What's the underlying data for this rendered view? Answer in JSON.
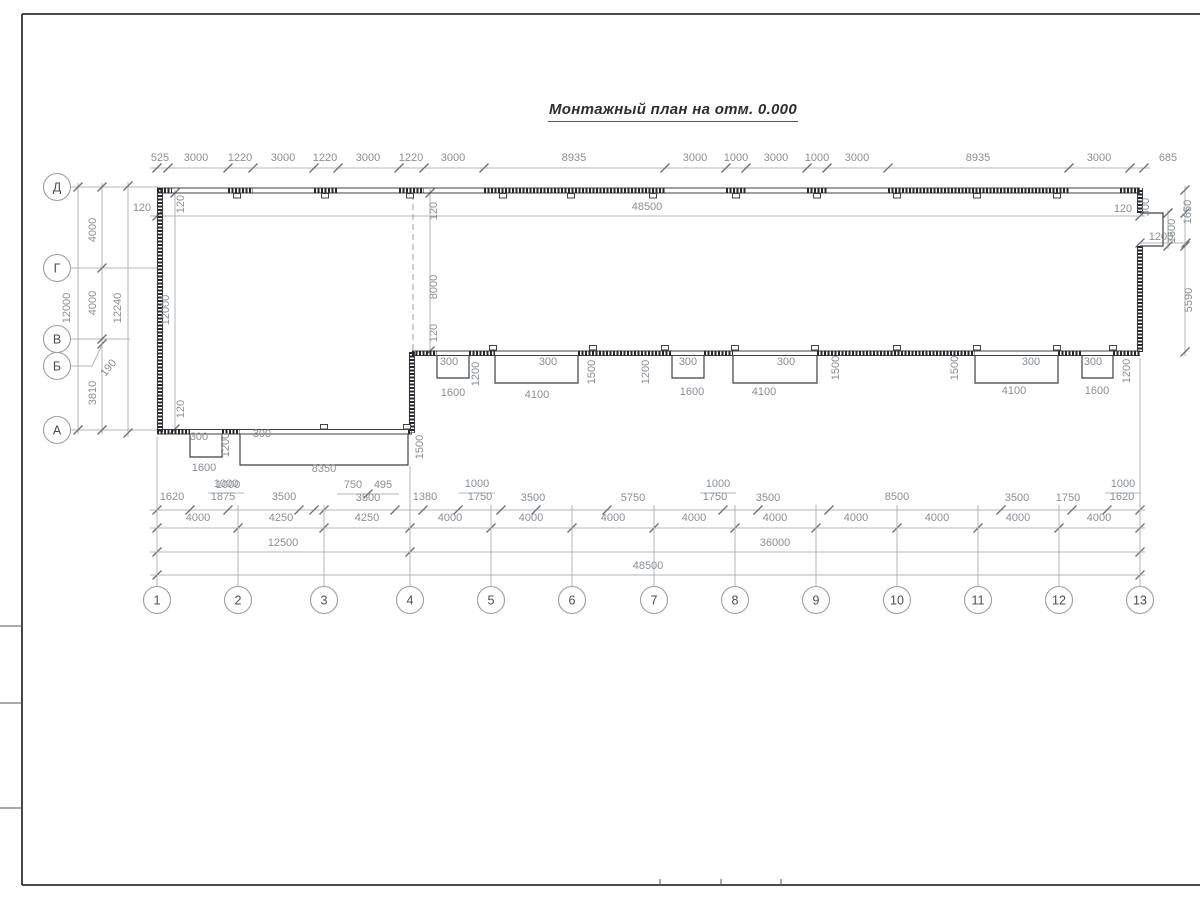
{
  "title": "Монтажный план на отм. 0.000",
  "colors": {
    "wall": "#3c4043",
    "wall_panel": "#26282b",
    "dim_line": "#b2b6ba",
    "dim_tick": "#6b6f73",
    "dim_text": "#8a8f94",
    "frame": "#333333"
  },
  "axes": {
    "rows": [
      {
        "label": "Д",
        "y": 187
      },
      {
        "label": "Г",
        "y": 268
      },
      {
        "label": "В",
        "y": 339
      },
      {
        "label": "Б",
        "y": 366
      },
      {
        "label": "А",
        "y": 430
      }
    ],
    "cols": [
      {
        "label": "1",
        "x": 157
      },
      {
        "label": "2",
        "x": 238
      },
      {
        "label": "3",
        "x": 324
      },
      {
        "label": "4",
        "x": 410
      },
      {
        "label": "5",
        "x": 491
      },
      {
        "label": "6",
        "x": 572
      },
      {
        "label": "7",
        "x": 654
      },
      {
        "label": "8",
        "x": 735
      },
      {
        "label": "9",
        "x": 816
      },
      {
        "label": "10",
        "x": 897
      },
      {
        "label": "11",
        "x": 978
      },
      {
        "label": "12",
        "x": 1059
      },
      {
        "label": "13",
        "x": 1140
      }
    ],
    "cols_y": 600,
    "rows_x": 57
  },
  "dim_labels": [
    {
      "t": "525",
      "x": 160,
      "y": 161
    },
    {
      "t": "3000",
      "x": 196,
      "y": 161
    },
    {
      "t": "1220",
      "x": 240,
      "y": 161
    },
    {
      "t": "3000",
      "x": 283,
      "y": 161
    },
    {
      "t": "1220",
      "x": 325,
      "y": 161
    },
    {
      "t": "3000",
      "x": 368,
      "y": 161
    },
    {
      "t": "1220",
      "x": 411,
      "y": 161
    },
    {
      "t": "3000",
      "x": 453,
      "y": 161
    },
    {
      "t": "8935",
      "x": 574,
      "y": 161
    },
    {
      "t": "3000",
      "x": 695,
      "y": 161
    },
    {
      "t": "1000",
      "x": 736,
      "y": 161
    },
    {
      "t": "3000",
      "x": 776,
      "y": 161
    },
    {
      "t": "1000",
      "x": 817,
      "y": 161
    },
    {
      "t": "3000",
      "x": 857,
      "y": 161
    },
    {
      "t": "8935",
      "x": 978,
      "y": 161
    },
    {
      "t": "3000",
      "x": 1099,
      "y": 161
    },
    {
      "t": "685",
      "x": 1168,
      "y": 161
    },
    {
      "t": "48500",
      "x": 647,
      "y": 210
    },
    {
      "t": "12000",
      "x": 70,
      "y": 308,
      "r": -90
    },
    {
      "t": "4000",
      "x": 96,
      "y": 230,
      "r": -90
    },
    {
      "t": "4000",
      "x": 96,
      "y": 303,
      "r": -90
    },
    {
      "t": "3810",
      "x": 96,
      "y": 393,
      "r": -90
    },
    {
      "t": "190",
      "x": 111,
      "y": 370,
      "r": -50
    },
    {
      "t": "12240",
      "x": 121,
      "y": 308,
      "r": -90
    },
    {
      "t": "12000",
      "x": 169,
      "y": 310,
      "r": -90
    },
    {
      "t": "120",
      "x": 184,
      "y": 204,
      "r": -90
    },
    {
      "t": "120",
      "x": 142,
      "y": 211
    },
    {
      "t": "120",
      "x": 184,
      "y": 409,
      "r": -90
    },
    {
      "t": "120",
      "x": 437,
      "y": 211,
      "r": -90
    },
    {
      "t": "8000",
      "x": 437,
      "y": 287,
      "r": -90
    },
    {
      "t": "120",
      "x": 437,
      "y": 333,
      "r": -90
    },
    {
      "t": "300",
      "x": 199,
      "y": 440
    },
    {
      "t": "1200",
      "x": 229,
      "y": 445,
      "r": -90
    },
    {
      "t": "300",
      "x": 262,
      "y": 437
    },
    {
      "t": "1600",
      "x": 204,
      "y": 471
    },
    {
      "t": "1000",
      "x": 228,
      "y": 488
    },
    {
      "t": "8350",
      "x": 324,
      "y": 472
    },
    {
      "t": "1500",
      "x": 423,
      "y": 447,
      "r": -90
    },
    {
      "t": "300",
      "x": 449,
      "y": 365
    },
    {
      "t": "1200",
      "x": 479,
      "y": 374,
      "r": -90
    },
    {
      "t": "1600",
      "x": 453,
      "y": 396
    },
    {
      "t": "300",
      "x": 548,
      "y": 365
    },
    {
      "t": "1500",
      "x": 595,
      "y": 372,
      "r": -90
    },
    {
      "t": "4100",
      "x": 537,
      "y": 398
    },
    {
      "t": "1200",
      "x": 649,
      "y": 372,
      "r": -90
    },
    {
      "t": "300",
      "x": 688,
      "y": 365
    },
    {
      "t": "1600",
      "x": 692,
      "y": 395
    },
    {
      "t": "300",
      "x": 786,
      "y": 365
    },
    {
      "t": "1500",
      "x": 839,
      "y": 368,
      "r": -90
    },
    {
      "t": "4100",
      "x": 764,
      "y": 395
    },
    {
      "t": "1500",
      "x": 958,
      "y": 368,
      "r": -90
    },
    {
      "t": "300",
      "x": 1031,
      "y": 365
    },
    {
      "t": "4100",
      "x": 1014,
      "y": 394
    },
    {
      "t": "300",
      "x": 1093,
      "y": 365
    },
    {
      "t": "1200",
      "x": 1130,
      "y": 371,
      "r": -90
    },
    {
      "t": "1600",
      "x": 1097,
      "y": 394
    },
    {
      "t": "300",
      "x": 1149,
      "y": 207,
      "r": -90
    },
    {
      "t": "120",
      "x": 1123,
      "y": 212
    },
    {
      "t": "1650",
      "x": 1191,
      "y": 212,
      "r": -90
    },
    {
      "t": "1600",
      "x": 1175,
      "y": 231,
      "r": -90
    },
    {
      "t": "1200",
      "x": 1161,
      "y": 240
    },
    {
      "t": "5590",
      "x": 1192,
      "y": 300,
      "r": -90
    },
    {
      "t": "1620",
      "x": 172,
      "y": 500
    },
    {
      "t": "1000",
      "x": 226,
      "y": 487
    },
    {
      "t": "1875",
      "x": 223,
      "y": 500
    },
    {
      "t": "3500",
      "x": 284,
      "y": 500
    },
    {
      "t": "750",
      "x": 353,
      "y": 488
    },
    {
      "t": "495",
      "x": 383,
      "y": 488
    },
    {
      "t": "3500",
      "x": 368,
      "y": 501
    },
    {
      "t": "1380",
      "x": 425,
      "y": 500
    },
    {
      "t": "1000",
      "x": 477,
      "y": 487
    },
    {
      "t": "1750",
      "x": 480,
      "y": 500
    },
    {
      "t": "3500",
      "x": 533,
      "y": 501
    },
    {
      "t": "5750",
      "x": 633,
      "y": 501
    },
    {
      "t": "1000",
      "x": 718,
      "y": 487
    },
    {
      "t": "1750",
      "x": 715,
      "y": 500
    },
    {
      "t": "3500",
      "x": 768,
      "y": 501
    },
    {
      "t": "8500",
      "x": 897,
      "y": 500
    },
    {
      "t": "3500",
      "x": 1017,
      "y": 501
    },
    {
      "t": "1750",
      "x": 1068,
      "y": 501
    },
    {
      "t": "1000",
      "x": 1123,
      "y": 487
    },
    {
      "t": "1620",
      "x": 1122,
      "y": 500
    },
    {
      "t": "4000",
      "x": 198,
      "y": 521
    },
    {
      "t": "4250",
      "x": 281,
      "y": 521
    },
    {
      "t": "4250",
      "x": 367,
      "y": 521
    },
    {
      "t": "4000",
      "x": 450,
      "y": 521
    },
    {
      "t": "4000",
      "x": 531,
      "y": 521
    },
    {
      "t": "4000",
      "x": 613,
      "y": 521
    },
    {
      "t": "4000",
      "x": 694,
      "y": 521
    },
    {
      "t": "4000",
      "x": 775,
      "y": 521
    },
    {
      "t": "4000",
      "x": 856,
      "y": 521
    },
    {
      "t": "4000",
      "x": 937,
      "y": 521
    },
    {
      "t": "4000",
      "x": 1018,
      "y": 521
    },
    {
      "t": "4000",
      "x": 1099,
      "y": 521
    },
    {
      "t": "12500",
      "x": 283,
      "y": 546
    },
    {
      "t": "36000",
      "x": 775,
      "y": 546
    },
    {
      "t": "48500",
      "x": 648,
      "y": 569
    }
  ]
}
